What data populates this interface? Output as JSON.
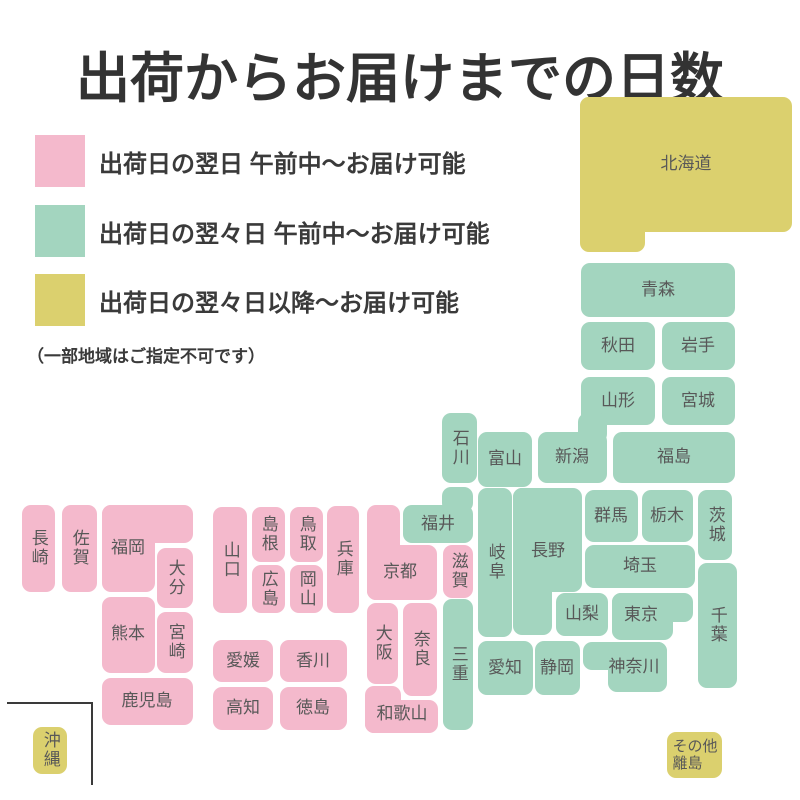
{
  "title": "出荷からお届けまでの日数",
  "colors": {
    "pink": "#F4B9CC",
    "green": "#A3D5BF",
    "yellow": "#DBD06E",
    "label": "#585858",
    "title": "#333333"
  },
  "legend": {
    "items": [
      {
        "key": "pink",
        "label": "出荷日の翌日 午前中〜お届け可能"
      },
      {
        "key": "green",
        "label": "出荷日の翌々日 午前中〜お届け可能"
      },
      {
        "key": "yellow",
        "label": "出荷日の翌々日以降〜お届け可能"
      }
    ],
    "note": "（一部地域はご指定不可です）"
  },
  "map": {
    "regions": [
      {
        "id": "hokkaido",
        "label": "北海道",
        "color": "yellow",
        "orient": "h",
        "lx": 686,
        "ly": 164,
        "rects": [
          [
            580,
            97,
            212,
            135
          ],
          [
            580,
            97,
            65,
            155
          ]
        ]
      },
      {
        "id": "aomori",
        "label": "青森",
        "color": "green",
        "orient": "h",
        "lx": 658,
        "ly": 290,
        "rects": [
          [
            581,
            263,
            154,
            54
          ]
        ]
      },
      {
        "id": "akita",
        "label": "秋田",
        "color": "green",
        "orient": "h",
        "lx": 618,
        "ly": 346,
        "rects": [
          [
            581,
            322,
            74,
            48
          ]
        ]
      },
      {
        "id": "iwate",
        "label": "岩手",
        "color": "green",
        "orient": "h",
        "lx": 698,
        "ly": 346,
        "rects": [
          [
            662,
            322,
            73,
            48
          ]
        ]
      },
      {
        "id": "yamagata",
        "label": "山形",
        "color": "green",
        "orient": "h",
        "lx": 618,
        "ly": 401,
        "rects": [
          [
            581,
            377,
            74,
            48
          ]
        ]
      },
      {
        "id": "miyagi",
        "label": "宮城",
        "color": "green",
        "orient": "h",
        "lx": 698,
        "ly": 401,
        "rects": [
          [
            662,
            377,
            73,
            48
          ]
        ]
      },
      {
        "id": "fukushima",
        "label": "福島",
        "color": "green",
        "orient": "h",
        "lx": 674,
        "ly": 457,
        "rects": [
          [
            613,
            432,
            122,
            51
          ]
        ]
      },
      {
        "id": "niigata",
        "label": "新潟",
        "color": "green",
        "orient": "h",
        "lx": 572,
        "ly": 457,
        "rects": [
          [
            538,
            432,
            69,
            51
          ],
          [
            578,
            413,
            29,
            30
          ]
        ]
      },
      {
        "id": "toyama",
        "label": "富山",
        "color": "green",
        "orient": "h",
        "lx": 505,
        "ly": 459,
        "rects": [
          [
            478,
            432,
            54,
            55
          ]
        ]
      },
      {
        "id": "ishikawa",
        "label": "石川",
        "color": "green",
        "orient": "v",
        "lx": 459,
        "ly": 448,
        "rects": [
          [
            442,
            413,
            35,
            70
          ]
        ]
      },
      {
        "id": "fukui",
        "label": "福井",
        "color": "green",
        "orient": "h",
        "lx": 438,
        "ly": 524,
        "rects": [
          [
            403,
            505,
            70,
            38
          ],
          [
            442,
            487,
            31,
            25
          ]
        ]
      },
      {
        "id": "gifu",
        "label": "岐阜",
        "color": "green",
        "orient": "v",
        "lx": 495,
        "ly": 562,
        "rects": [
          [
            478,
            488,
            34,
            149
          ]
        ]
      },
      {
        "id": "nagano",
        "label": "長野",
        "color": "green",
        "orient": "h",
        "lx": 548,
        "ly": 551,
        "rects": [
          [
            513,
            488,
            69,
            104
          ],
          [
            513,
            488,
            39,
            147
          ]
        ]
      },
      {
        "id": "gunma",
        "label": "群馬",
        "color": "green",
        "orient": "h",
        "lx": 611,
        "ly": 516,
        "rects": [
          [
            585,
            490,
            53,
            52
          ]
        ]
      },
      {
        "id": "tochigi",
        "label": "栃木",
        "color": "green",
        "orient": "h",
        "lx": 667,
        "ly": 516,
        "rects": [
          [
            642,
            490,
            51,
            52
          ]
        ]
      },
      {
        "id": "ibaraki",
        "label": "茨城",
        "color": "green",
        "orient": "v",
        "lx": 715,
        "ly": 525,
        "rects": [
          [
            698,
            490,
            34,
            70
          ]
        ]
      },
      {
        "id": "saitama",
        "label": "埼玉",
        "color": "green",
        "orient": "h",
        "lx": 640,
        "ly": 566,
        "rects": [
          [
            585,
            545,
            110,
            43
          ]
        ]
      },
      {
        "id": "yamanashi",
        "label": "山梨",
        "color": "green",
        "orient": "h",
        "lx": 582,
        "ly": 614,
        "rects": [
          [
            556,
            593,
            52,
            43
          ]
        ]
      },
      {
        "id": "tokyo",
        "label": "東京",
        "color": "green",
        "orient": "h",
        "lx": 641,
        "ly": 615,
        "rects": [
          [
            612,
            593,
            81,
            29
          ],
          [
            612,
            593,
            61,
            47
          ]
        ]
      },
      {
        "id": "chiba",
        "label": "千葉",
        "color": "green",
        "orient": "v",
        "lx": 717,
        "ly": 625,
        "rects": [
          [
            698,
            563,
            39,
            125
          ]
        ]
      },
      {
        "id": "kanagawa",
        "label": "神奈川",
        "color": "green",
        "orient": "h",
        "lx": 634,
        "ly": 667,
        "rects": [
          [
            583,
            642,
            84,
            28
          ],
          [
            608,
            642,
            59,
            50
          ]
        ]
      },
      {
        "id": "shizuoka",
        "label": "静岡",
        "color": "green",
        "orient": "h",
        "lx": 557,
        "ly": 668,
        "rects": [
          [
            535,
            641,
            45,
            54
          ]
        ]
      },
      {
        "id": "aichi",
        "label": "愛知",
        "color": "green",
        "orient": "h",
        "lx": 505,
        "ly": 668,
        "rects": [
          [
            478,
            641,
            55,
            54
          ]
        ]
      },
      {
        "id": "mie",
        "label": "三重",
        "color": "green",
        "orient": "v",
        "lx": 458,
        "ly": 664,
        "rects": [
          [
            443,
            599,
            30,
            131
          ]
        ]
      },
      {
        "id": "shiga",
        "label": "滋賀",
        "color": "pink",
        "orient": "v",
        "lx": 458,
        "ly": 571,
        "rects": [
          [
            443,
            545,
            30,
            53
          ]
        ]
      },
      {
        "id": "kyoto",
        "label": "京都",
        "color": "pink",
        "orient": "h",
        "lx": 400,
        "ly": 572,
        "rects": [
          [
            367,
            505,
            33,
            95
          ],
          [
            367,
            545,
            70,
            55
          ]
        ]
      },
      {
        "id": "osaka",
        "label": "大阪",
        "color": "pink",
        "orient": "v",
        "lx": 382,
        "ly": 643,
        "rects": [
          [
            367,
            603,
            31,
            81
          ]
        ]
      },
      {
        "id": "nara",
        "label": "奈良",
        "color": "pink",
        "orient": "v",
        "lx": 420,
        "ly": 649,
        "rects": [
          [
            403,
            603,
            34,
            93
          ]
        ]
      },
      {
        "id": "wakayama",
        "label": "和歌山",
        "color": "pink",
        "orient": "h",
        "lx": 402,
        "ly": 714,
        "rects": [
          [
            365,
            686,
            36,
            47
          ],
          [
            365,
            700,
            73,
            33
          ]
        ]
      },
      {
        "id": "hyogo",
        "label": "兵庫",
        "color": "pink",
        "orient": "v",
        "lx": 343,
        "ly": 559,
        "rects": [
          [
            327,
            506,
            32,
            107
          ]
        ]
      },
      {
        "id": "tottori",
        "label": "鳥取",
        "color": "pink",
        "orient": "v",
        "lx": 306,
        "ly": 534,
        "rects": [
          [
            290,
            507,
            33,
            55
          ]
        ]
      },
      {
        "id": "shimane",
        "label": "島根",
        "color": "pink",
        "orient": "v",
        "lx": 268,
        "ly": 534,
        "rects": [
          [
            252,
            507,
            33,
            55
          ]
        ]
      },
      {
        "id": "okayama",
        "label": "岡山",
        "color": "pink",
        "orient": "v",
        "lx": 306,
        "ly": 589,
        "rects": [
          [
            290,
            565,
            33,
            48
          ]
        ]
      },
      {
        "id": "hiroshima",
        "label": "広島",
        "color": "pink",
        "orient": "v",
        "lx": 268,
        "ly": 589,
        "rects": [
          [
            252,
            565,
            33,
            48
          ]
        ]
      },
      {
        "id": "yamaguchi",
        "label": "山口",
        "color": "pink",
        "orient": "v",
        "lx": 230,
        "ly": 560,
        "rects": [
          [
            213,
            507,
            34,
            106
          ]
        ]
      },
      {
        "id": "kagawa",
        "label": "香川",
        "color": "pink",
        "orient": "h",
        "lx": 313,
        "ly": 661,
        "rects": [
          [
            280,
            640,
            67,
            42
          ]
        ]
      },
      {
        "id": "ehime",
        "label": "愛媛",
        "color": "pink",
        "orient": "h",
        "lx": 243,
        "ly": 661,
        "rects": [
          [
            213,
            640,
            60,
            42
          ]
        ]
      },
      {
        "id": "tokushima",
        "label": "徳島",
        "color": "pink",
        "orient": "h",
        "lx": 313,
        "ly": 708,
        "rects": [
          [
            280,
            687,
            67,
            43
          ]
        ]
      },
      {
        "id": "kochi",
        "label": "高知",
        "color": "pink",
        "orient": "h",
        "lx": 243,
        "ly": 708,
        "rects": [
          [
            213,
            687,
            60,
            43
          ]
        ]
      },
      {
        "id": "fukuoka",
        "label": "福岡",
        "color": "pink",
        "orient": "h",
        "lx": 128,
        "ly": 548,
        "rects": [
          [
            102,
            505,
            91,
            38
          ],
          [
            102,
            505,
            53,
            87
          ]
        ]
      },
      {
        "id": "saga",
        "label": "佐賀",
        "color": "pink",
        "orient": "v",
        "lx": 79,
        "ly": 548,
        "rects": [
          [
            62,
            505,
            35,
            87
          ]
        ]
      },
      {
        "id": "nagasaki",
        "label": "長崎",
        "color": "pink",
        "orient": "v",
        "lx": 38,
        "ly": 548,
        "rects": [
          [
            22,
            505,
            33,
            87
          ]
        ]
      },
      {
        "id": "oita",
        "label": "大分",
        "color": "pink",
        "orient": "v",
        "lx": 175,
        "ly": 578,
        "rects": [
          [
            157,
            548,
            36,
            60
          ]
        ]
      },
      {
        "id": "kumamoto",
        "label": "熊本",
        "color": "pink",
        "orient": "h",
        "lx": 128,
        "ly": 634,
        "rects": [
          [
            102,
            597,
            53,
            76
          ]
        ]
      },
      {
        "id": "miyazaki",
        "label": "宮崎",
        "color": "pink",
        "orient": "v",
        "lx": 175,
        "ly": 642,
        "rects": [
          [
            157,
            612,
            36,
            61
          ]
        ]
      },
      {
        "id": "kagoshima",
        "label": "鹿児島",
        "color": "pink",
        "orient": "h",
        "lx": 147,
        "ly": 701,
        "rects": [
          [
            102,
            678,
            91,
            47
          ]
        ]
      },
      {
        "id": "okinawa",
        "label": "沖縄",
        "color": "yellow",
        "orient": "v",
        "lx": 50,
        "ly": 750,
        "rects": [
          [
            33,
            727,
            34,
            47
          ]
        ]
      },
      {
        "id": "other-islands",
        "label": "その他\n離島",
        "color": "yellow",
        "orient": "h",
        "lx": 695,
        "ly": 755,
        "rects": [
          [
            667,
            732,
            55,
            46
          ]
        ]
      }
    ],
    "okinawa_frame": {
      "x": 7,
      "y": 702,
      "w": 84,
      "h": 81
    }
  }
}
